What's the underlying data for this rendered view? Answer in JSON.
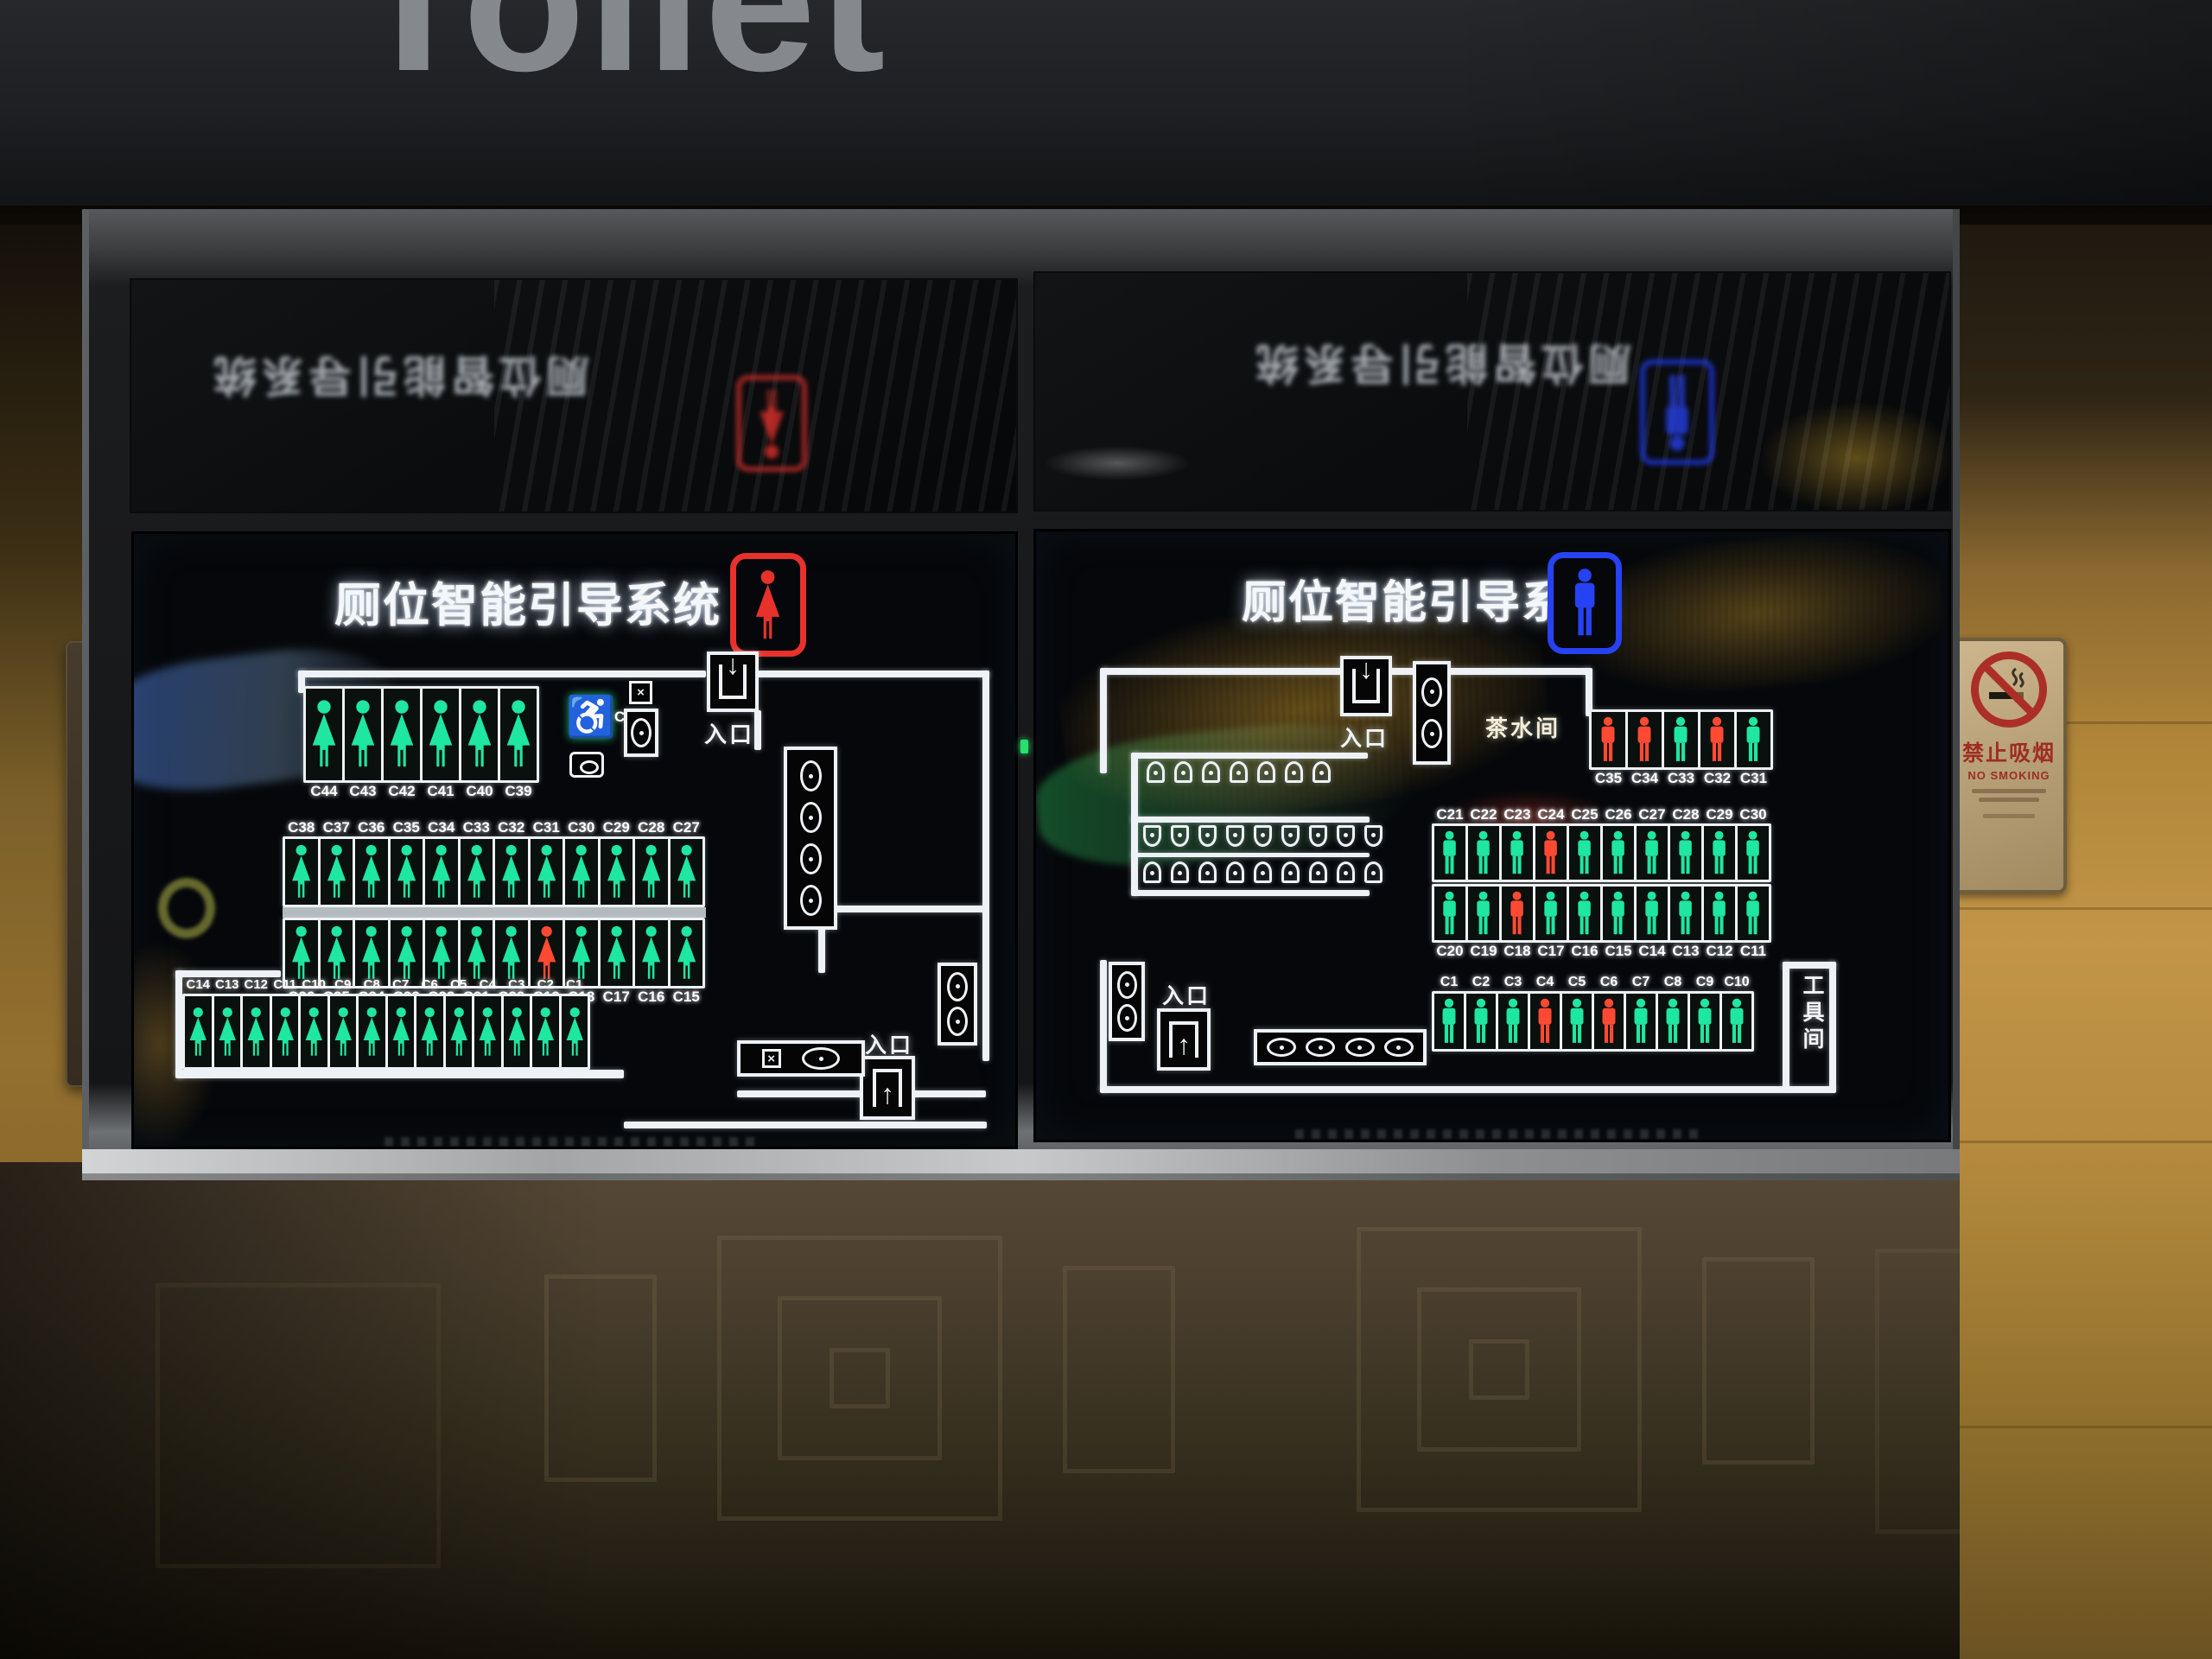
{
  "header": {
    "title": "Toilet"
  },
  "signs": {
    "no_smoking_cn": "禁止吸烟",
    "no_smoking_en": "NO SMOKING"
  },
  "colors": {
    "vacant": "#1fe6a1",
    "occupied": "#ff4a33",
    "female": "#e8312c",
    "male": "#2742f2"
  },
  "left_screen": {
    "title": "厕位智能引导系统",
    "gender": "female",
    "entrance_top": "入口",
    "entrance_bottom": "入口",
    "accessible_id": "C45",
    "rows": {
      "top": {
        "ids": [
          "C44",
          "C43",
          "C42",
          "C41",
          "C40",
          "C39"
        ],
        "occupied": []
      },
      "mid_upper": {
        "ids": [
          "C38",
          "C37",
          "C36",
          "C35",
          "C34",
          "C33",
          "C32",
          "C31",
          "C30",
          "C29",
          "C28",
          "C27"
        ],
        "occupied": []
      },
      "mid_lower": {
        "ids": [
          "C26",
          "C25",
          "C24",
          "C23",
          "C22",
          "C21",
          "C20",
          "C19",
          "C18",
          "C17",
          "C16",
          "C15"
        ],
        "occupied": [
          "C19"
        ]
      },
      "bottom": {
        "ids": [
          "C14",
          "C13",
          "C12",
          "C11",
          "C10",
          "C9",
          "C8",
          "C7",
          "C6",
          "C5",
          "C4",
          "C3",
          "C2",
          "C1"
        ],
        "occupied": []
      }
    },
    "fixtures": {
      "corridor_sinks": 4,
      "corner_sinks": 2,
      "counter_sinks": 1
    }
  },
  "right_screen": {
    "title": "厕位智能引导系统",
    "gender": "male",
    "entrance_top": "入口",
    "entrance_bottom": "入口",
    "tea_room": "茶水间",
    "tool_room": "工具间",
    "rows": {
      "side": {
        "ids": [
          "C35",
          "C34",
          "C33",
          "C32",
          "C31"
        ],
        "occupied": [
          "C35",
          "C34",
          "C32"
        ]
      },
      "mid_upper": {
        "ids": [
          "C21",
          "C22",
          "C23",
          "C24",
          "C25",
          "C26",
          "C27",
          "C28",
          "C29",
          "C30"
        ],
        "occupied": [
          "C24"
        ]
      },
      "mid_lower": {
        "ids": [
          "C20",
          "C19",
          "C18",
          "C17",
          "C16",
          "C15",
          "C14",
          "C13",
          "C12",
          "C11"
        ],
        "occupied": [
          "C18"
        ]
      },
      "bottom": {
        "ids": [
          "C1",
          "C2",
          "C3",
          "C4",
          "C5",
          "C6",
          "C7",
          "C8",
          "C9",
          "C10"
        ],
        "occupied": [
          "C4",
          "C6"
        ]
      }
    },
    "urinals": {
      "top_row": 7,
      "band_upper": 9,
      "band_lower": 9
    },
    "fixtures": {
      "top_sinks": 2,
      "corner_sinks": 2,
      "counter_sinks": 4
    }
  }
}
